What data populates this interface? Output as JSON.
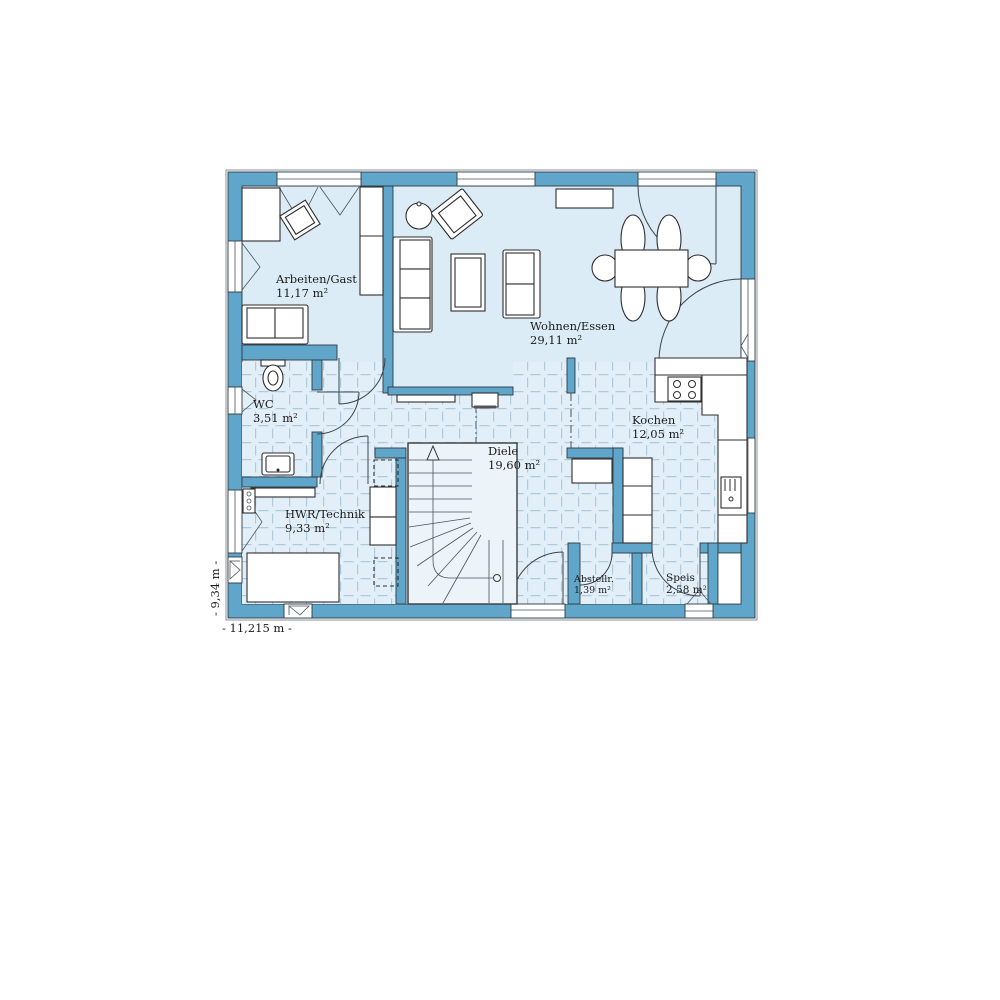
{
  "plan": {
    "type": "floor-plan",
    "rooms": [
      {
        "id": "arbeiten",
        "name": "Arbeiten/Gast",
        "area": "11,17 m²"
      },
      {
        "id": "wohnen",
        "name": "Wohnen/Essen",
        "area": "29,11 m²"
      },
      {
        "id": "wc",
        "name": "WC",
        "area": "3,51 m²"
      },
      {
        "id": "kochen",
        "name": "Kochen",
        "area": "12,05 m²"
      },
      {
        "id": "diele",
        "name": "Diele",
        "area": "19,60 m²"
      },
      {
        "id": "hwr",
        "name": "HWR/Technik",
        "area": "9,33 m²"
      },
      {
        "id": "abstell",
        "name": "Abstellr.",
        "area": "1,39 m²"
      },
      {
        "id": "speis",
        "name": "Speis",
        "area": "2,58 m²"
      }
    ],
    "dimensions": {
      "width": "- 11,215 m -",
      "height": "- 9,34 m -"
    },
    "colors": {
      "wall": "#5fa6ca",
      "room_fill": "#dcecf6",
      "tile_fill": "#e3eff8",
      "tile_line": "#aecbdd",
      "outline": "#2e3a42",
      "background": "#ffffff"
    }
  }
}
